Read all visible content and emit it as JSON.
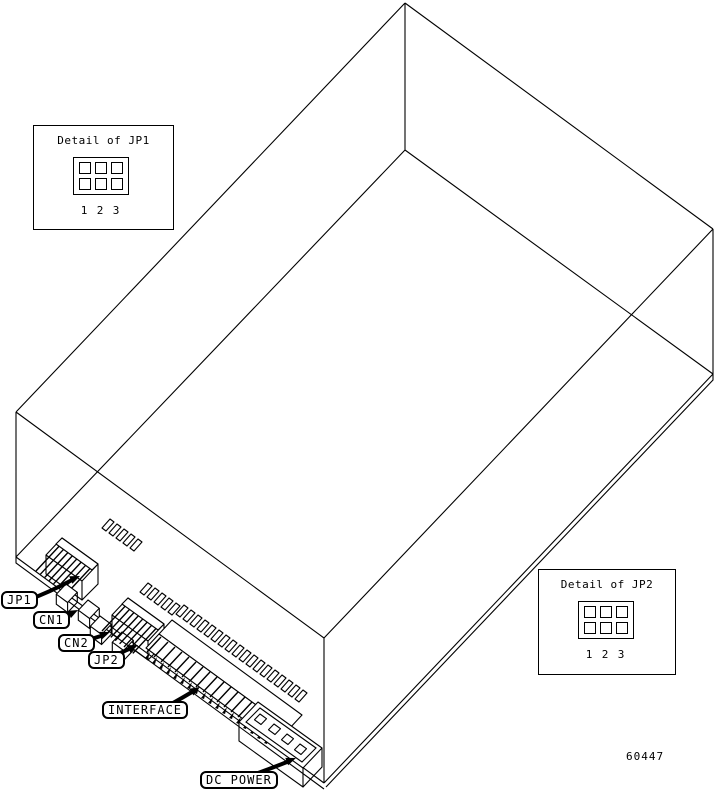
{
  "figure": {
    "number": "60447",
    "background": "#ffffff",
    "line_color": "#000000"
  },
  "detail_boxes": [
    {
      "title": "Detail of JP1",
      "pins": [
        "1",
        "2",
        "3"
      ]
    },
    {
      "title": "Detail of JP2",
      "pins": [
        "1",
        "2",
        "3"
      ]
    }
  ],
  "callouts": {
    "jp1": "JP1",
    "cn1": "CN1",
    "cn2": "CN2",
    "jp2": "JP2",
    "interface": "INTERFACE",
    "dc_power": "DC POWER"
  }
}
